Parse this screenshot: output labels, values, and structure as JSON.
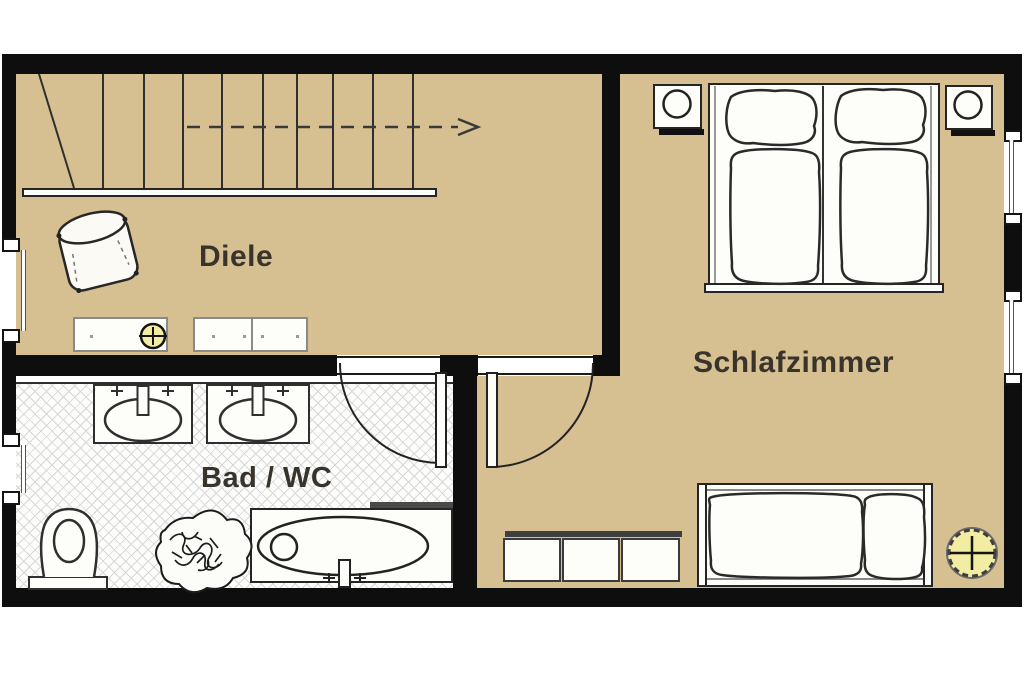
{
  "floorplan": {
    "rooms": [
      {
        "name": "diele",
        "label": "Diele"
      },
      {
        "name": "bad-wc",
        "label": "Bad / WC"
      },
      {
        "name": "schlafzimmer",
        "label": "Schlafzimmer"
      }
    ],
    "stair_arrow_direction": "right",
    "symbols": {
      "lamp_small": "circle-with-cross-yellow",
      "lamp_ceiling": "dashed-circle-with-cross-yellow",
      "window": "double-jamb-with-glass-line",
      "door": "quarter-circle-swing"
    },
    "colors": {
      "floor_tan": "#d6c091",
      "wall_black": "#0e0e0e",
      "tile_line_gray": "#d7d7d7",
      "lamp_yellow": "#f2eda2",
      "outline": "#252525",
      "label_text": "#39342b",
      "page_background": "#ffffff"
    }
  }
}
